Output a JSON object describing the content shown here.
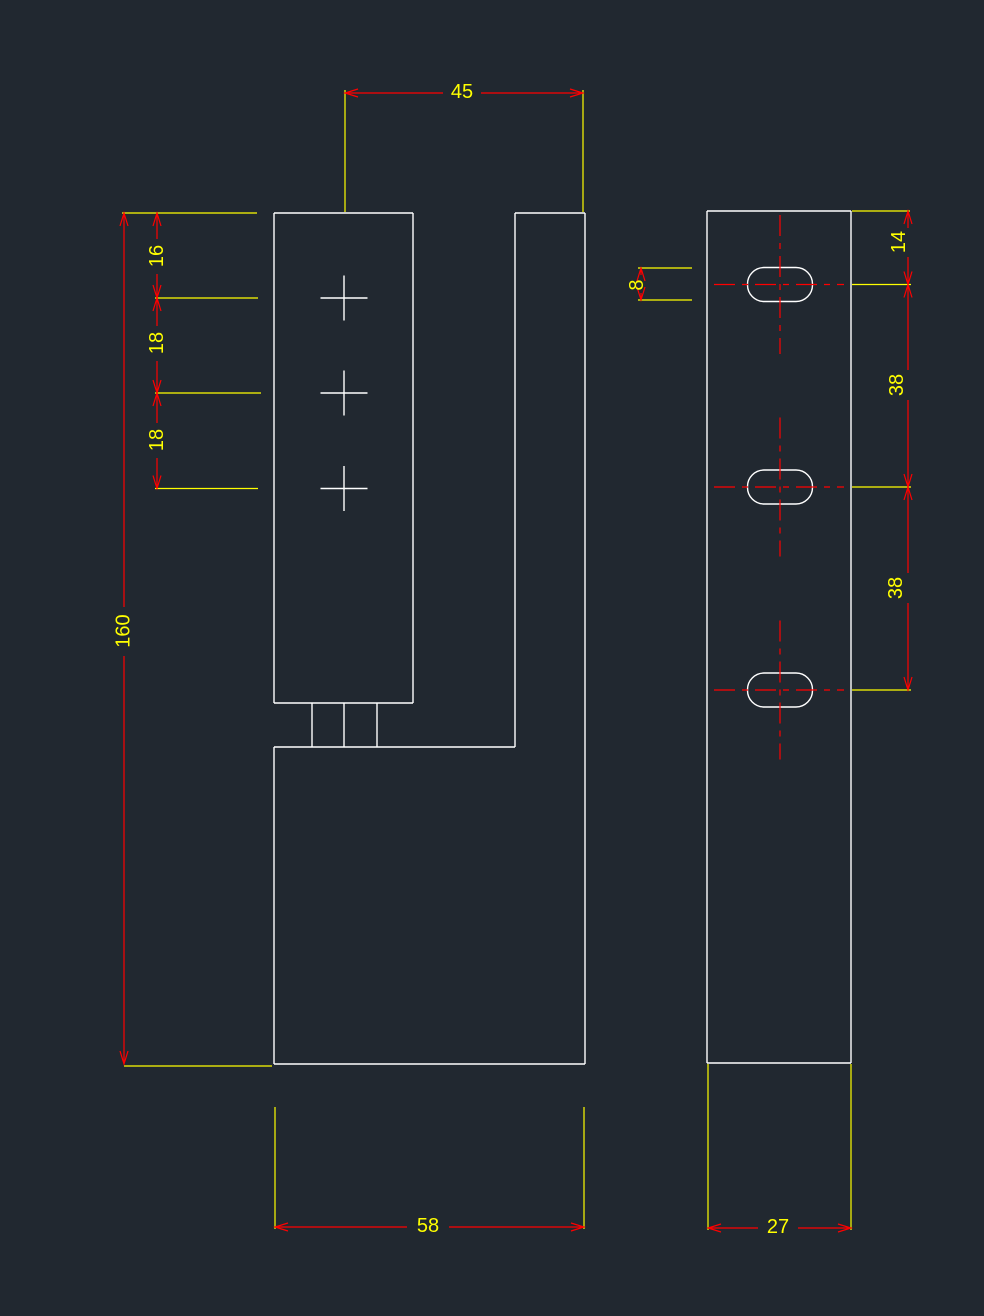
{
  "colors": {
    "background": "#212830",
    "geometry": "#ffffff",
    "extension": "#ffff00",
    "dimension": "#ff0000",
    "centerline": "#ff0000",
    "text": "#ffff00"
  },
  "views": {
    "front": {
      "dims": {
        "width_top": "45",
        "hole_offset_top": "16",
        "hole_pitch_1": "18",
        "hole_pitch_2": "18",
        "overall_height": "160",
        "width_bottom": "58"
      }
    },
    "side": {
      "dims": {
        "slot_height": "8",
        "slot_offset_top": "14",
        "slot_pitch_1": "38",
        "slot_pitch_2": "38",
        "overall_width": "27"
      }
    }
  }
}
